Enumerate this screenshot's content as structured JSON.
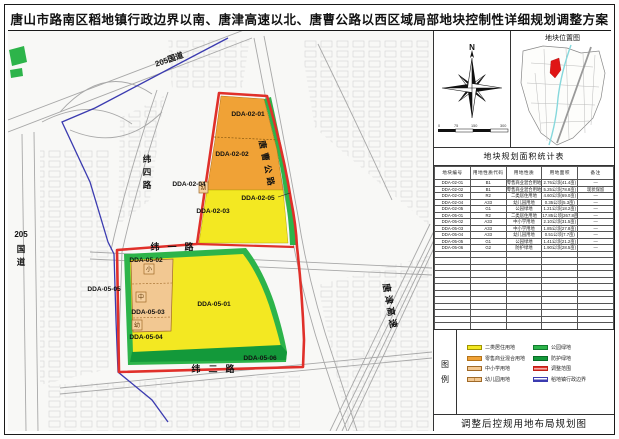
{
  "title": "唐山市路南区稻地镇行政边界以南、唐津高速以北、唐曹公路以西区域局部地块控制性详细规划调整方案",
  "colors": {
    "residential_yellow": "#f3e822",
    "commercial_orange": "#f0a236",
    "school_tan": "#f2c892",
    "park_green": "#2db44a",
    "protective_green": "#13993a",
    "adjust_red": "#e0302a",
    "boundary_blue": "#3b3bb0"
  },
  "map": {
    "labels": [
      {
        "t": "DDA-02-01",
        "x": 248,
        "y": 116,
        "size": 6.6
      },
      {
        "t": "DDA-02-02",
        "x": 232,
        "y": 156,
        "size": 6.6
      },
      {
        "t": "DDA-02-04",
        "x": 189,
        "y": 186,
        "size": 6.6
      },
      {
        "t": "DDA-02-05",
        "x": 258,
        "y": 200,
        "size": 6.6
      },
      {
        "t": "DDA-02-03",
        "x": 213,
        "y": 213,
        "size": 6.6
      },
      {
        "t": "DDA-05-02",
        "x": 146,
        "y": 262,
        "size": 6.6
      },
      {
        "t": "DDA-05-05",
        "x": 104,
        "y": 291,
        "size": 6.6
      },
      {
        "t": "DDA-05-01",
        "x": 214,
        "y": 306,
        "size": 6.6
      },
      {
        "t": "DDA-05-03",
        "x": 148,
        "y": 314,
        "size": 6.6
      },
      {
        "t": "DDA-05-04",
        "x": 146,
        "y": 339,
        "size": 6.6
      },
      {
        "t": "DDA-05-06",
        "x": 260,
        "y": 360,
        "size": 6.6
      },
      {
        "t": "纬一路",
        "x": 176,
        "y": 250,
        "size": 9,
        "ls": 8
      },
      {
        "t": "纬二路",
        "x": 217,
        "y": 372,
        "size": 9,
        "ls": 8
      },
      {
        "t": "纬四路",
        "x": 147,
        "y": 162,
        "size": 8.5,
        "vertical": true,
        "dy": 13
      },
      {
        "t": "205国道",
        "x": 170,
        "y": 62,
        "size": 8,
        "rot": -19
      },
      {
        "t": "205",
        "x": 21,
        "y": 237,
        "size": 8
      },
      {
        "t": "国道",
        "x": 21,
        "y": 252,
        "size": 8.5,
        "vertical": true,
        "dy": 13
      },
      {
        "t": "唐曹公路",
        "x": 259,
        "y": 141,
        "size": 8.5,
        "rot": 78,
        "ls": 4,
        "anchor": "start"
      },
      {
        "t": "唐津高速",
        "x": 383,
        "y": 284,
        "size": 9,
        "rot": 80,
        "ls": 3,
        "anchor": "start"
      }
    ],
    "glyphs": [
      {
        "t": "幼",
        "box": [
          199,
          182,
          9,
          11
        ]
      },
      {
        "t": "小",
        "box": [
          144,
          264,
          10,
          10
        ]
      },
      {
        "t": "中",
        "box": [
          136,
          292,
          10,
          10
        ]
      },
      {
        "t": "幼",
        "box": [
          132,
          320,
          10,
          10
        ]
      }
    ]
  },
  "panel": {
    "north_label": "N",
    "scale_ticks": [
      "0",
      "75",
      "150",
      "300"
    ],
    "location_map_title": "地块位置图",
    "table_title": "地块规划面积统计表",
    "table": {
      "columns": [
        "地块编号",
        "用地性质代码",
        "用地性质",
        "用地面积",
        "备注"
      ],
      "rows": [
        [
          "DDA-02-01",
          "B1",
          "零售商业混合用地",
          "2.76公顷(41.4亩)",
          "—"
        ],
        [
          "DDA-02-02",
          "B1",
          "零售商业混合用地",
          "5.25公顷(78.8亩)",
          "现状保留"
        ],
        [
          "DDA-02-03",
          "R2",
          "二类居住用地",
          "4.60公顷(69.0亩)",
          "—"
        ],
        [
          "DDA-02-04",
          "A33",
          "幼儿园用地",
          "0.35公顷(5.3亩)",
          "—"
        ],
        [
          "DDA-02-05",
          "G1",
          "公园绿地",
          "1.21公顷(18.2亩)",
          "—"
        ],
        [
          "DDA-05-01",
          "R2",
          "二类居住用地",
          "17.85公顷(267.8亩)",
          "—"
        ],
        [
          "DDA-05-02",
          "A33",
          "中小学用地",
          "2.10公顷(31.5亩)",
          "—"
        ],
        [
          "DDA-05-03",
          "A33",
          "中小学用地",
          "1.85公顷(27.8亩)",
          "—"
        ],
        [
          "DDA-05-04",
          "A33",
          "幼儿园用地",
          "0.51公顷(7.7亩)",
          "—"
        ],
        [
          "DDA-05-05",
          "G1",
          "公园绿地",
          "1.41公顷(21.2亩)",
          "—"
        ],
        [
          "DDA-05-06",
          "G2",
          "防护绿地",
          "1.90公顷(28.5亩)",
          "—"
        ]
      ],
      "empty_rows": 12
    },
    "legend_title": "图例",
    "legend": {
      "left": [
        {
          "label": "二类居住用地",
          "swatch": "yellow"
        },
        {
          "label": "零售商业混合用地",
          "swatch": "orange"
        },
        {
          "label": "中小学用地",
          "swatch": "school"
        },
        {
          "label": "幼儿园用地",
          "swatch": "kindergarten"
        }
      ],
      "right": [
        {
          "label": "公园绿地",
          "swatch": "green"
        },
        {
          "label": "防护绿地",
          "swatch": "darkgreen"
        },
        {
          "label": "调整范围",
          "swatch": "redline"
        },
        {
          "label": "稻地镇行政边界",
          "swatch": "blueline"
        }
      ]
    },
    "caption": "调整后控规用地布局规划图"
  }
}
